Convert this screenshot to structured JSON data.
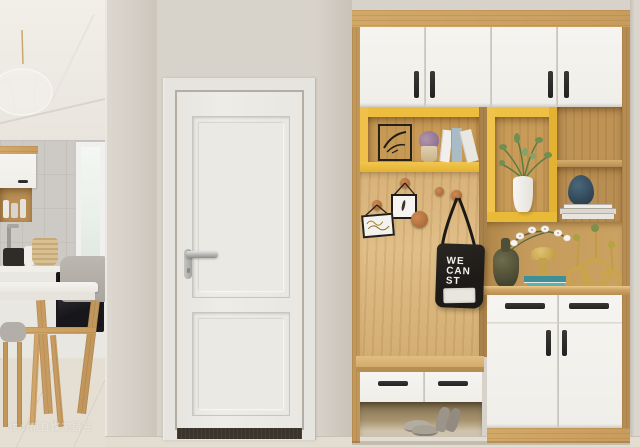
{
  "scene": {
    "kind": "interior-photo",
    "description": "Bright hallway: open kitchen-dining glimpse at left, white panelled interior door in the middle, and a built-in oak and white entryway storage unit with yellow open shelves, coat-hook wall, hanging tote bag, decor objects, shoe bench and white cabinets at right."
  },
  "watermark": {
    "text": "住小帮自媒家居号"
  },
  "tote_bag": {
    "lines": [
      "WE",
      "CAN",
      "ST"
    ]
  },
  "palette": {
    "wall": "#d8d3ca",
    "ceiling": "#f0ede7",
    "door_white": "#eae8e3",
    "oak_wood": "#cda668",
    "hook_panel_wood": "#dcb981",
    "cabinet_white": "#f3f1ed",
    "accent_yellow": "#edbd3f",
    "handle_black": "#2b2926",
    "bag_black": "#211e1b",
    "navy_vase": "#35505f",
    "teal_decor": "#4b9aa1",
    "gold_decor": "#c9a449",
    "floor_tile": "#e3ddd2"
  },
  "objects": {
    "kitchen": [
      "pendant-light",
      "window",
      "upper-cabinet",
      "jar-shelf",
      "basket",
      "faucet",
      "kettle",
      "built-in-oven",
      "dining-table",
      "chair",
      "stool"
    ],
    "door": [
      "door-frame",
      "door-slab",
      "upper-panel",
      "lower-panel",
      "lever-handle",
      "doormat"
    ],
    "storage_unit": [
      "top-cabinets",
      "yellow-open-shelf",
      "wire-art-frame",
      "succulent-pot",
      "books",
      "hook-wall",
      "hanging-frame",
      "hanging-sign",
      "wood-knobs",
      "tote-bag",
      "yellow-display-box",
      "white-vase-greenery",
      "cube-shelves",
      "navy-vase",
      "book-stack",
      "orchid-vase",
      "gold-mushroom",
      "teal-books",
      "gold-ring-holders",
      "sideboard",
      "shoe-bench",
      "shoes"
    ]
  }
}
